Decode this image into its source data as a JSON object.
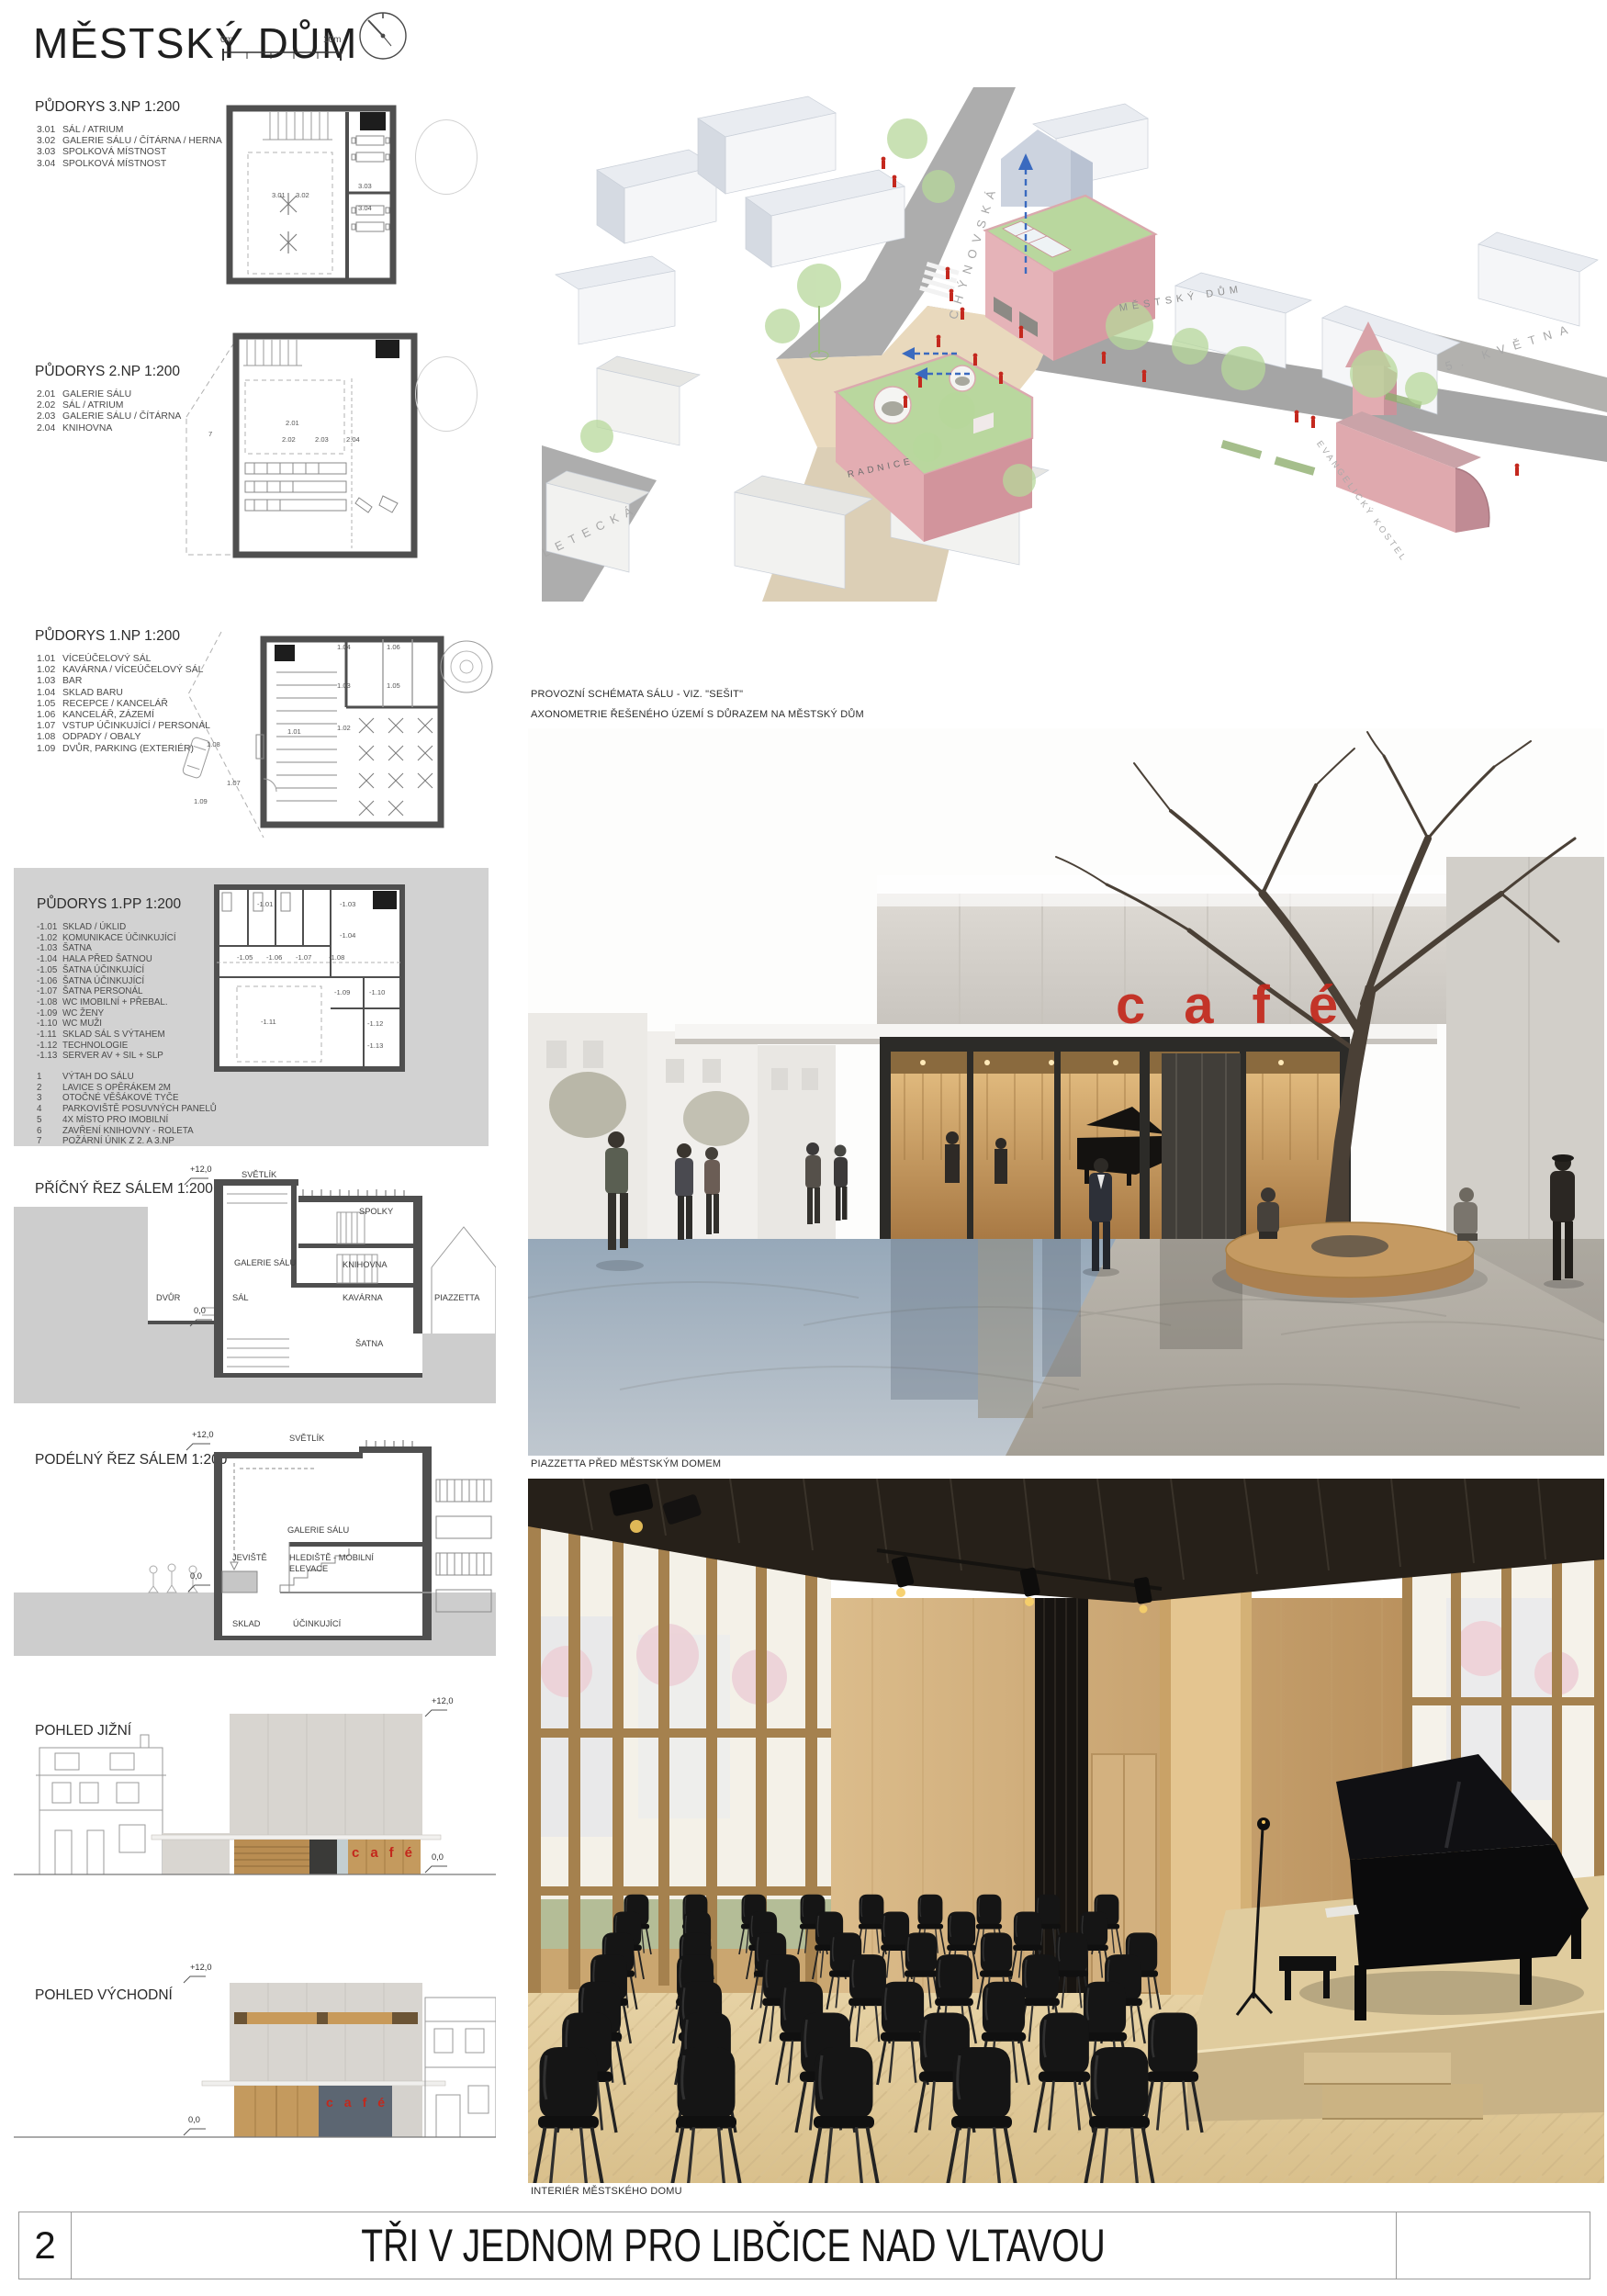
{
  "header": {
    "title": "MĚSTSKÝ DŮM",
    "scale": {
      "start": "0m",
      "end": "10m"
    }
  },
  "plans": [
    {
      "title": "PŮDORYS 3.NP 1:200",
      "items": [
        {
          "num": "3.01",
          "label": "SÁL / ATRIUM"
        },
        {
          "num": "3.02",
          "label": "GALERIE SÁLU / ČÍTÁRNA / HERNA"
        },
        {
          "num": "3.03",
          "label": "SPOLKOVÁ MÍSTNOST"
        },
        {
          "num": "3.04",
          "label": "SPOLKOVÁ MÍSTNOST"
        }
      ],
      "plan_labels": [
        "3.01",
        "3.02",
        "3.03",
        "3.04"
      ]
    },
    {
      "title": "PŮDORYS 2.NP 1:200",
      "items": [
        {
          "num": "2.01",
          "label": "GALERIE SÁLU"
        },
        {
          "num": "2.02",
          "label": "SÁL / ATRIUM"
        },
        {
          "num": "2.03",
          "label": "GALERIE SÁLU / ČÍTÁRNA"
        },
        {
          "num": "2.04",
          "label": "KNIHOVNA"
        }
      ],
      "plan_labels": [
        "2.01",
        "2.02",
        "2.03",
        "2.04",
        "7"
      ]
    },
    {
      "title": "PŮDORYS 1.NP 1:200",
      "items": [
        {
          "num": "1.01",
          "label": "VÍCEÚČELOVÝ SÁL"
        },
        {
          "num": "1.02",
          "label": "KAVÁRNA / VÍCEÚČELOVÝ SÁL"
        },
        {
          "num": "1.03",
          "label": "BAR"
        },
        {
          "num": "1.04",
          "label": "SKLAD BARU"
        },
        {
          "num": "1.05",
          "label": "RECEPCE / KANCELÁŘ"
        },
        {
          "num": "1.06",
          "label": "KANCELÁŘ, ZÁZEMÍ"
        },
        {
          "num": "1.07",
          "label": "VSTUP ÚČINKUJÍCÍ / PERSONÁL"
        },
        {
          "num": "1.08",
          "label": "ODPADY / OBALY"
        },
        {
          "num": "1.09",
          "label": "DVŮR, PARKING (EXTERIÉR)"
        }
      ],
      "plan_labels": [
        "1.04",
        "1.06",
        "1.03",
        "1.05",
        "1.02",
        "1.01",
        "1.08",
        "1.07",
        "1.09"
      ]
    },
    {
      "title": "PŮDORYS 1.PP 1:200",
      "items": [
        {
          "num": "-1.01",
          "label": "SKLAD / ÚKLID"
        },
        {
          "num": "-1.02",
          "label": "KOMUNIKACE ÚČINKUJÍCÍ"
        },
        {
          "num": "-1.03",
          "label": "ŠATNA"
        },
        {
          "num": "-1.04",
          "label": "HALA PŘED ŠATNOU"
        },
        {
          "num": "-1.05",
          "label": "ŠATNA ÚČINKUJÍCÍ"
        },
        {
          "num": "-1.06",
          "label": "ŠATNA ÚČINKUJÍCÍ"
        },
        {
          "num": "-1.07",
          "label": "ŠATNA PERSONÁL"
        },
        {
          "num": "-1.08",
          "label": "WC IMOBILNÍ + PŘEBAL."
        },
        {
          "num": "-1.09",
          "label": "WC ŽENY"
        },
        {
          "num": "-1.10",
          "label": "WC MUŽI"
        },
        {
          "num": "-1.11",
          "label": "SKLAD SÁL S VÝTAHEM"
        },
        {
          "num": "-1.12",
          "label": "TECHNOLOGIE"
        },
        {
          "num": "-1.13",
          "label": "SERVER AV + SIL + SLP"
        }
      ],
      "notes": [
        {
          "num": "1",
          "label": "VÝTAH DO SÁLU"
        },
        {
          "num": "2",
          "label": "LAVICE S OPĚRÁKEM 2M"
        },
        {
          "num": "3",
          "label": "OTOČNÉ VĚŠÁKOVÉ TYČE"
        },
        {
          "num": "4",
          "label": "PARKOVIŠTĚ POSUVNÝCH PANELŮ"
        },
        {
          "num": "5",
          "label": "4X MÍSTO PRO IMOBILNÍ"
        },
        {
          "num": "6",
          "label": "ZAVŘENÍ KNIHOVNY - ROLETA"
        },
        {
          "num": "7",
          "label": "POŽÁRNÍ ÚNIK Z 2. A 3.NP"
        }
      ],
      "plan_labels": [
        "-1.01",
        "-1.03",
        "-1.04",
        "-1.05",
        "-1.06",
        "-1.07",
        "-1.08",
        "-1.09",
        "-1.10",
        "-1.11",
        "-1.12",
        "-1.13"
      ]
    }
  ],
  "sections": [
    {
      "title": "PŘÍČNÝ ŘEZ SÁLEM 1:200",
      "level_top": "+12,0",
      "level_zero": "0,0",
      "labels": [
        "SVĚTLÍK",
        "SPOLKY",
        "GALERIE SÁLU",
        "KNIHOVNA",
        "DVŮR",
        "SÁL",
        "KAVÁRNA",
        "PIAZZETTA",
        "ŠATNA"
      ]
    },
    {
      "title": "PODÉLNÝ ŘEZ SÁLEM 1:200",
      "level_top": "+12,0",
      "level_zero": "0,0",
      "labels": [
        "SVĚTLÍK",
        "GALERIE SÁLU",
        "JEVIŠTĚ",
        "HLEDIŠTĚ - MOBILNÍ",
        "ELEVACE",
        "SKLAD",
        "ÚČINKUJÍCÍ"
      ]
    }
  ],
  "elevations": [
    {
      "title": "POHLED JIŽNÍ",
      "level_top": "+12,0",
      "level_zero": "0,0",
      "sign": "café"
    },
    {
      "title": "POHLED VÝCHODNÍ",
      "level_top": "+12,0",
      "level_zero": "0,0",
      "sign": "café"
    }
  ],
  "axon": {
    "captions": [
      "PROVOZNÍ SCHÉMATA SÁLU - VIZ. \"SEŠIT\"",
      "AXONOMETRIE ŘEŠENÉHO ÚZEMÍ S DŮRAZEM NA MĚSTSKÝ DŮM"
    ],
    "street_labels": [
      "CHÝNOVSKÁ",
      "MĚSTSKÝ DŮM",
      "5. KVĚTNA",
      "LETECKÁ"
    ],
    "building_labels": [
      "RADNICE",
      "EVANGELICKÝ KOSTEL"
    ]
  },
  "renders": [
    {
      "caption": "PIAZZETTA PŘED MĚSTSKÝM DOMEM",
      "sign": "café"
    },
    {
      "caption": "INTERIÉR MĚSTSKÉHO DOMU"
    }
  ],
  "footer": {
    "page_number": "2",
    "title": "TŘI V JEDNOM PRO LIBČICE NAD VLTAVOU"
  },
  "colors": {
    "accent_red": "#c3281c",
    "plan_wall": "#4f4f4f",
    "panel_gray": "#d2d2d2",
    "axon_pink": "#e5b3b8",
    "axon_green": "#b9d79e",
    "wood": "#c49a5e"
  }
}
